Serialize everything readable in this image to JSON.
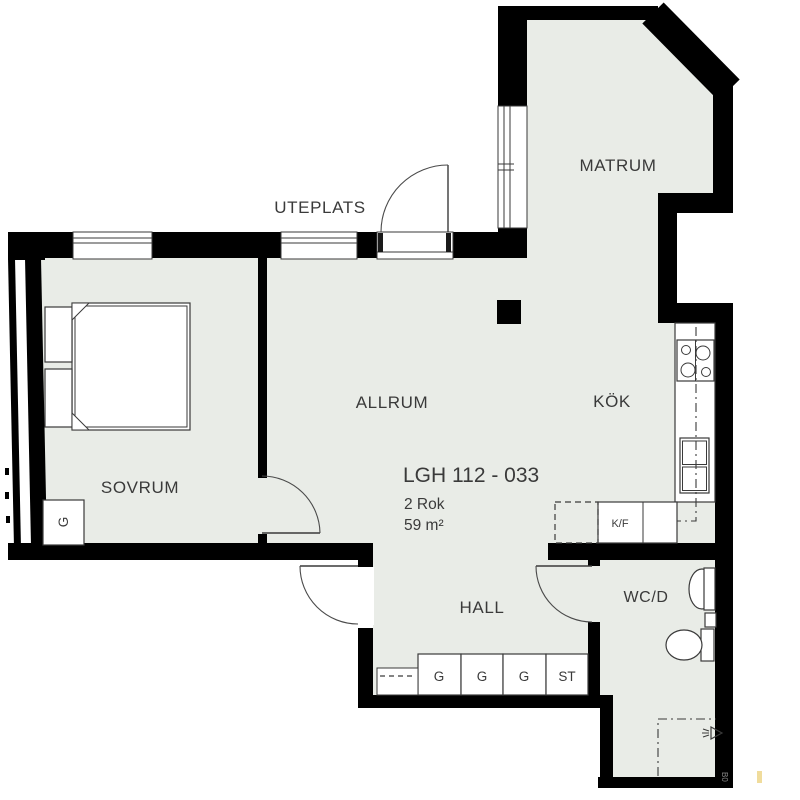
{
  "plan": {
    "apartment": {
      "id_label": "LGH 112 - 033",
      "rooms_label": "2 Rok",
      "area_label": "59 m²"
    },
    "rooms": {
      "matrum": "MATRUM",
      "uteplats": "UTEPLATS",
      "allrum": "ALLRUM",
      "kok": "KÖK",
      "sovrum": "SOVRUM",
      "hall": "HALL",
      "wcd": "WC/D"
    },
    "closets": {
      "sovrum_g": "G",
      "hall_1": "G",
      "hall_2": "G",
      "hall_3": "G",
      "hall_4": "ST",
      "kf": "K/F"
    },
    "fixtures": [
      "bed",
      "stove",
      "kitchen-sink",
      "fridge-freezer",
      "wc-sink",
      "toilet",
      "shower-drain"
    ],
    "stamp": "B0",
    "colors": {
      "floor": "#e9ece7",
      "wall": "#000000",
      "line": "#3a3a3a",
      "text": "#3a3a3a",
      "outside": "#ffffff",
      "stamp_mark": "#f0dc9c"
    }
  }
}
